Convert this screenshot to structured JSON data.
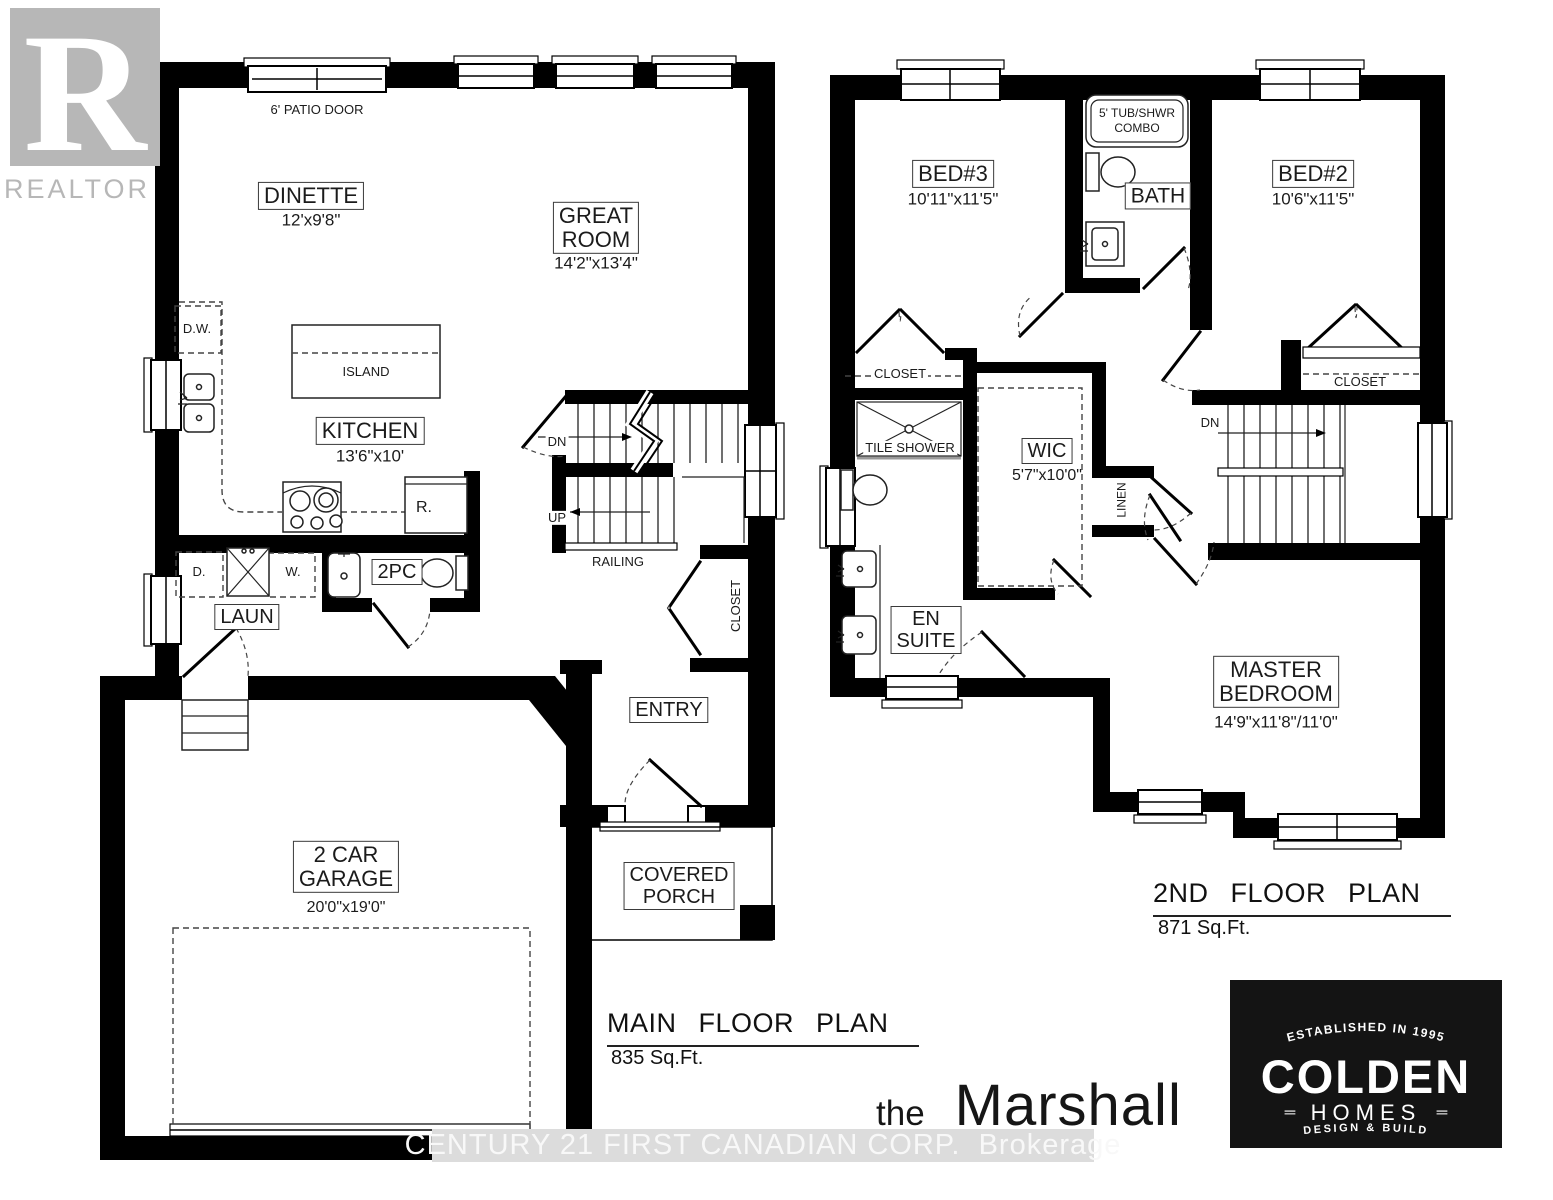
{
  "watermarks": {
    "realtor_symbol": "R",
    "realtor_text": "REALTOR",
    "registered": "®",
    "brokerage": "CENTURY 21 FIRST CANADIAN CORP.  Brokerage"
  },
  "plan_name": {
    "prefix": "the",
    "name": "Marshall"
  },
  "main_floor": {
    "title": "MAIN FLOOR PLAN",
    "area": "835 Sq.Ft.",
    "patio_door": "6' PATIO DOOR",
    "dinette": "DINETTE",
    "dinette_dims": "12'x9'8\"",
    "great_room_line1": "GREAT",
    "great_room_line2": "ROOM",
    "great_room_dims": "14'2\"x13'4\"",
    "dishwasher": "D.W.",
    "island": "ISLAND",
    "kitchen": "KITCHEN",
    "kitchen_dims": "13'6\"x10'",
    "fridge": "R.",
    "dryer": "D.",
    "washer": "W.",
    "powder": "2PC",
    "laundry": "LAUN",
    "stairs_dn": "DN",
    "stairs_up": "UP",
    "railing": "RAILING",
    "closet": "CLOSET",
    "entry": "ENTRY",
    "porch_line1": "COVERED",
    "porch_line2": "PORCH",
    "garage_line1": "2 CAR",
    "garage_line2": "GARAGE",
    "garage_dims": "20'0\"x19'0\""
  },
  "second_floor": {
    "title": "2ND FLOOR PLAN",
    "area": "871 Sq.Ft.",
    "tub_line1": "5' TUB/SHWR",
    "tub_line2": "COMBO",
    "bed3": "BED#3",
    "bed3_dims": "10'11\"x11'5\"",
    "bath": "BATH",
    "bed2": "BED#2",
    "bed2_dims": "10'6\"x11'5\"",
    "closet_bed3": "CLOSET",
    "closet_bed2": "CLOSET",
    "tile_shower": "TILE SHOWER",
    "wic": "WIC",
    "wic_dims": "5'7\"x10'0\"",
    "linen": "LINEN",
    "stairs_dn": "DN",
    "ensuite_line1": "EN",
    "ensuite_line2": "SUITE",
    "master_line1": "MASTER",
    "master_line2": "BEDROOM",
    "master_dims": "14'9\"x11'8\"/11'0\""
  },
  "builder_logo": {
    "established": "ESTABLISHED IN 1995",
    "name": "COLDEN",
    "homes": "HOMES",
    "deco": "═",
    "tagline": "DESIGN  &  BUILD"
  },
  "colors": {
    "wall": "#000000",
    "label": "#1b1b1b",
    "watermark_gray": "#b7b7b7",
    "brokerage_band": "#dcdcdc",
    "brokerage_text": "#f8f8f8",
    "logo_bg": "#141414"
  }
}
